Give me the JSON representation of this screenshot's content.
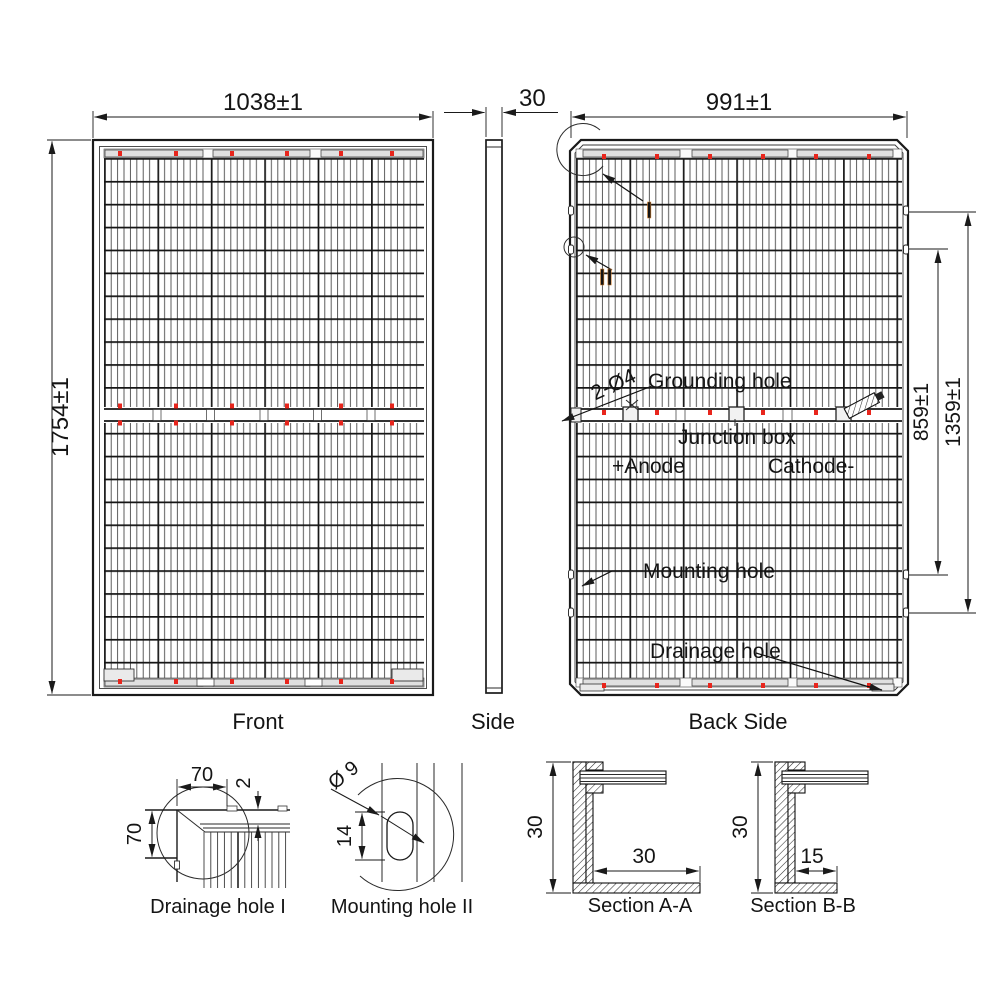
{
  "views": {
    "front": {
      "caption": "Front",
      "dim_width": "1038±1",
      "dim_height": "1754±1"
    },
    "side": {
      "caption": "Side",
      "dim_thickness": "30"
    },
    "back": {
      "caption": "Back Side",
      "dim_width": "991±1",
      "dim_mount_inner": "859±1",
      "dim_mount_outer": "1359±1",
      "ref_drainage_detail": "I",
      "ref_mounting_detail": "II",
      "grounding_qty": "2-Ø4",
      "grounding_label": "Grounding hole",
      "junction_label": "Junction box",
      "anode_label": "+Anode",
      "cathode_label": "Cathode-",
      "mounting_label": "Mounting hole",
      "drainage_label": "Drainage hole"
    }
  },
  "details": {
    "drainage": {
      "caption": "Drainage hole I",
      "dim_width": "70",
      "dim_height": "70",
      "dim_gap": "2"
    },
    "mounting": {
      "caption": "Mounting hole II",
      "dim_diameter": "Ø 9",
      "dim_length": "14"
    },
    "section_aa": {
      "caption": "Section A-A",
      "dim_height": "30",
      "dim_flange": "30"
    },
    "section_bb": {
      "caption": "Section B-B",
      "dim_height": "30",
      "dim_flange": "15"
    }
  },
  "colors": {
    "line": "#1a1a1a",
    "red_mark": "#e8251c",
    "ref_blue": "#2f6db5",
    "ref_light_blue": "#8fd8f5",
    "ref_orange": "#cf7a28",
    "background": "#ffffff"
  }
}
